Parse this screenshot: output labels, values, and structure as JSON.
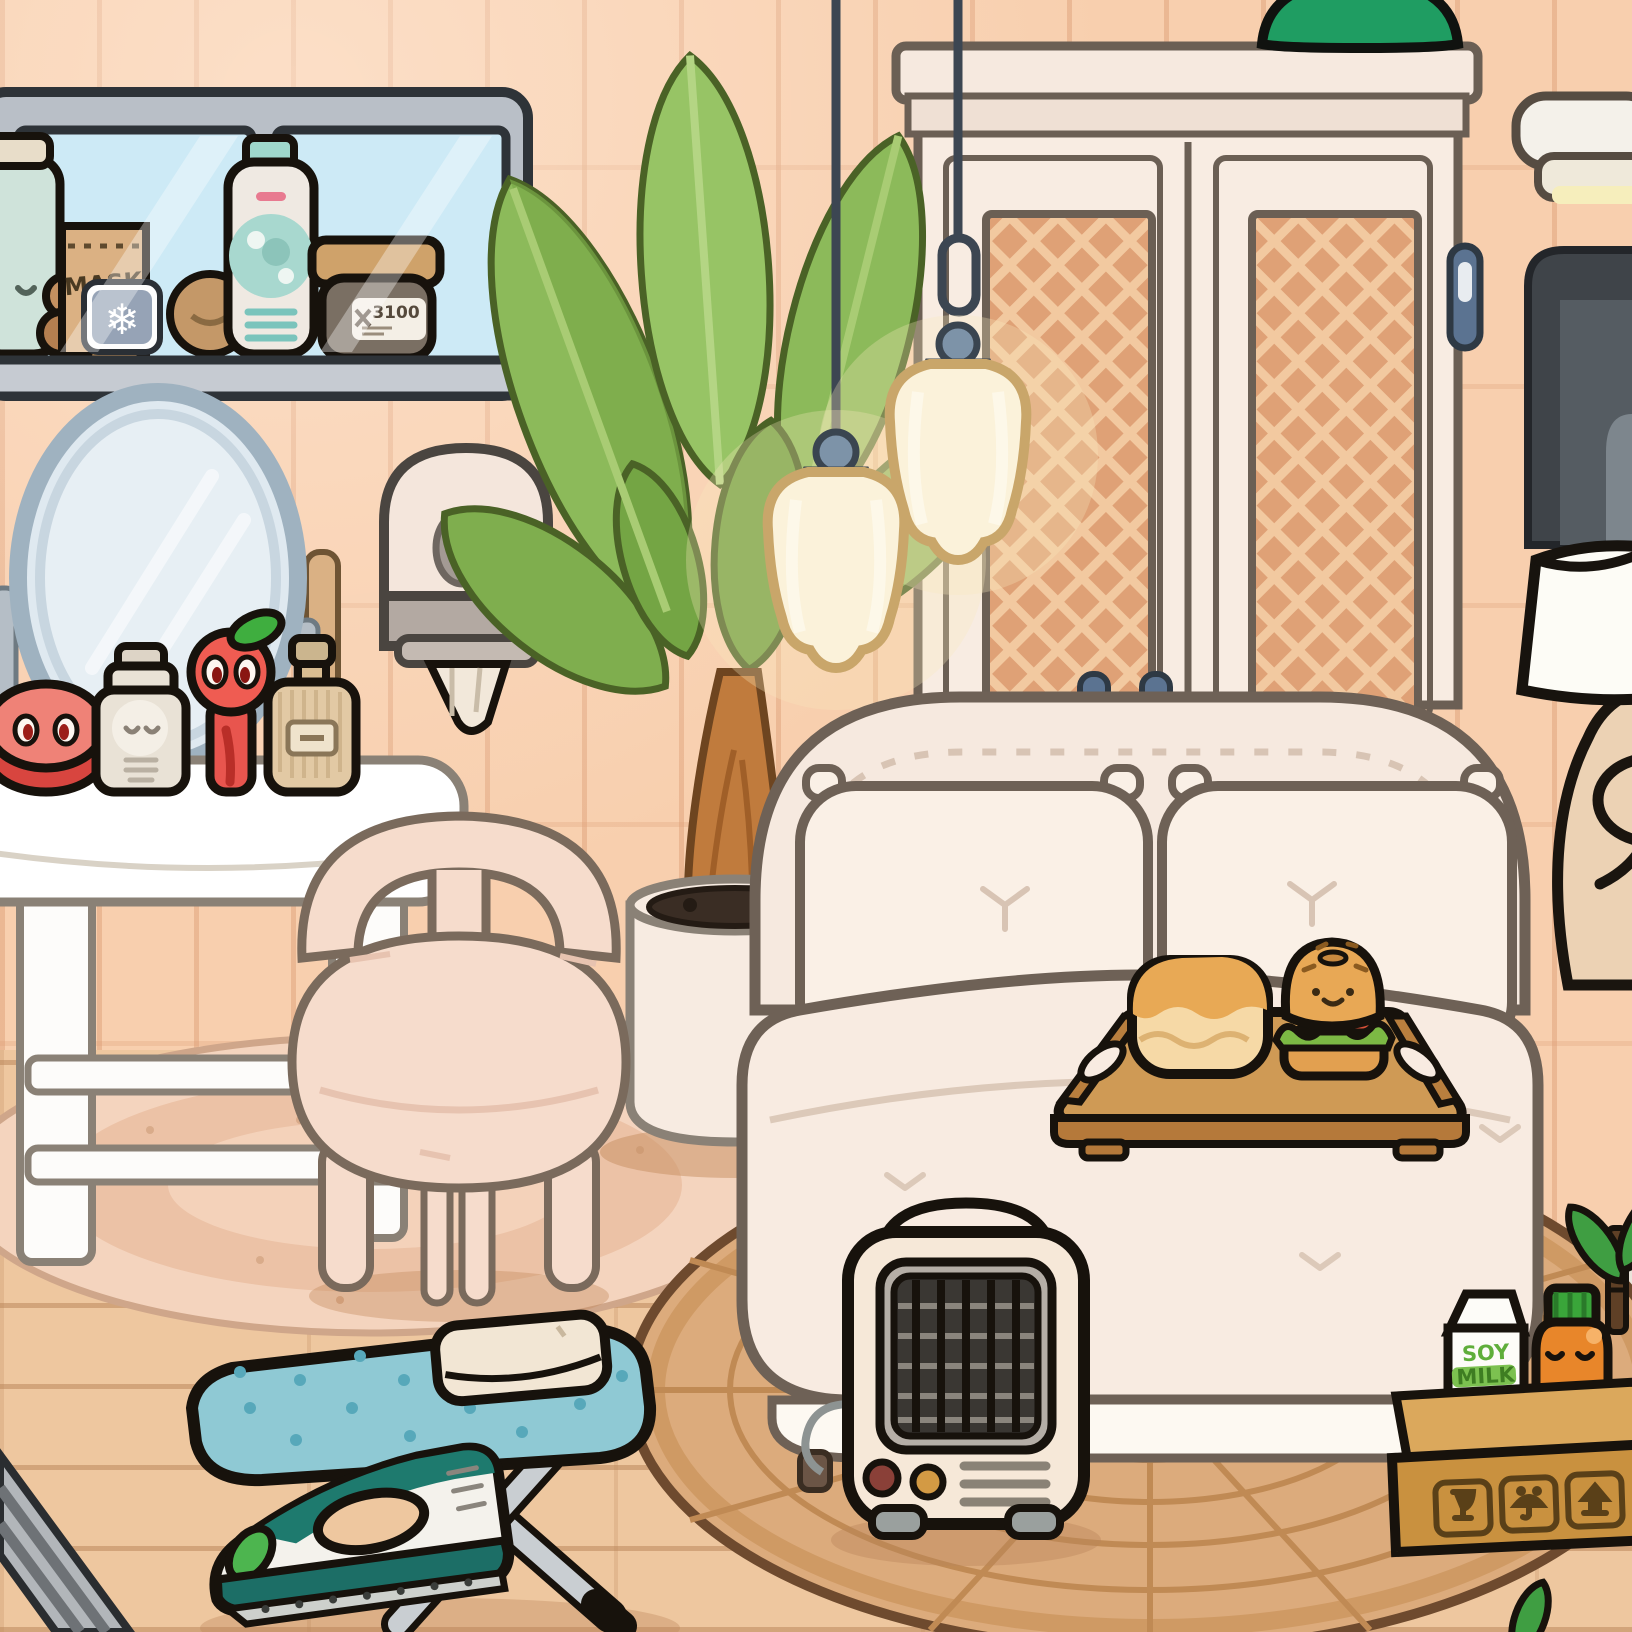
{
  "scene": {
    "game_style": "toca-life-room",
    "room": "bedroom",
    "view": "interior-scene"
  },
  "texts": {
    "mask_box": "MASK",
    "cream_jar_label": "3100",
    "soy_milk_top": "SOY",
    "soy_milk_bottom": "MILK"
  },
  "icons": [
    "snowflake-icon",
    "fragile-glass-icon",
    "keep-dry-umbrella-icon",
    "this-side-up-icon"
  ],
  "colors": {
    "wall_tile": "#f8cfae",
    "wall_grout": "#e2a680",
    "floor_wood": "#eec79f",
    "baseboard": "#eae4da",
    "bed_cream": "#f6e9df",
    "rug_pink": "#f3d2bc",
    "rug_jute": "#dcab7c",
    "plant_green": "#8cba5a",
    "ironing_board_blue": "#8fc9d4",
    "iron_teal": "#1e7a6e",
    "pendant_glow": "#f7e9bd",
    "wardrobe_rattan": "#dfa176",
    "handle_blue": "#5b7391",
    "box_cardboard": "#c9913f",
    "juice_orange": "#e8862a",
    "soy_text_green": "#5fae3a",
    "heater_cream": "#f6e8d8"
  }
}
